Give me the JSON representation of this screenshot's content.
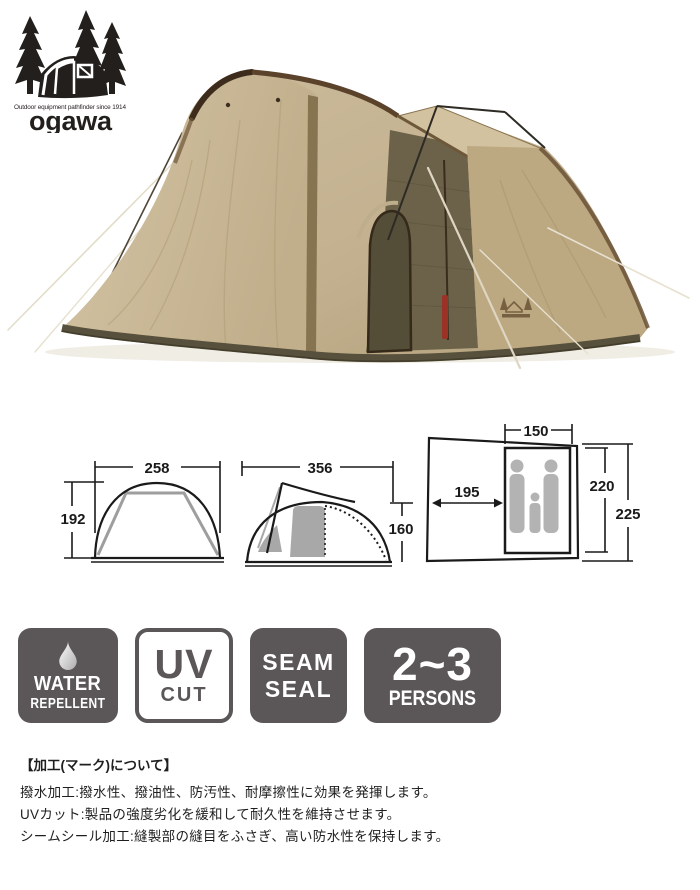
{
  "logo": {
    "tagline": "Outdoor equipment pathfinder since 1914",
    "wordmark": "ogawa"
  },
  "product_photo": {
    "description": "tan dome tent with brown trim, mesh front door, top visor and guy ropes"
  },
  "diagrams": {
    "front_view": {
      "width": "258",
      "height": "192"
    },
    "side_view": {
      "width": "356",
      "height": "160"
    },
    "floor_plan": {
      "width": "150",
      "vestibule_depth": "195",
      "inner_length": "220",
      "total_length": "225"
    }
  },
  "badges": [
    {
      "name": "water-repellent",
      "line1": "WATER",
      "line2": "REPELLENT"
    },
    {
      "name": "uv-cut",
      "line1": "UV",
      "line2": "CUT"
    },
    {
      "name": "seam-seal",
      "line1": "SEAM",
      "line2": "SEAL"
    },
    {
      "name": "capacity",
      "line1": "2~3",
      "line2": "PERSONS"
    }
  ],
  "notes": {
    "heading": "【加工(マーク)について】",
    "lines": [
      "撥水加工:撥水性、撥油性、防汚性、耐摩擦性に効果を発揮します。",
      "UVカット:製品の強度劣化を緩和して耐久性を維持させます。",
      "シームシール加工:縫製部の縫目をふさぎ、高い防水性を保持します。"
    ]
  },
  "colors": {
    "badge_gray": "#5b5657",
    "tent_tan": "#c3b190",
    "tent_tan_light": "#cdbd9c",
    "mesh_olive": "#6b6249",
    "trim_brown": "#4a3726",
    "diagram_gray": "#a8a8a8",
    "red_zip": "#9c3126"
  }
}
